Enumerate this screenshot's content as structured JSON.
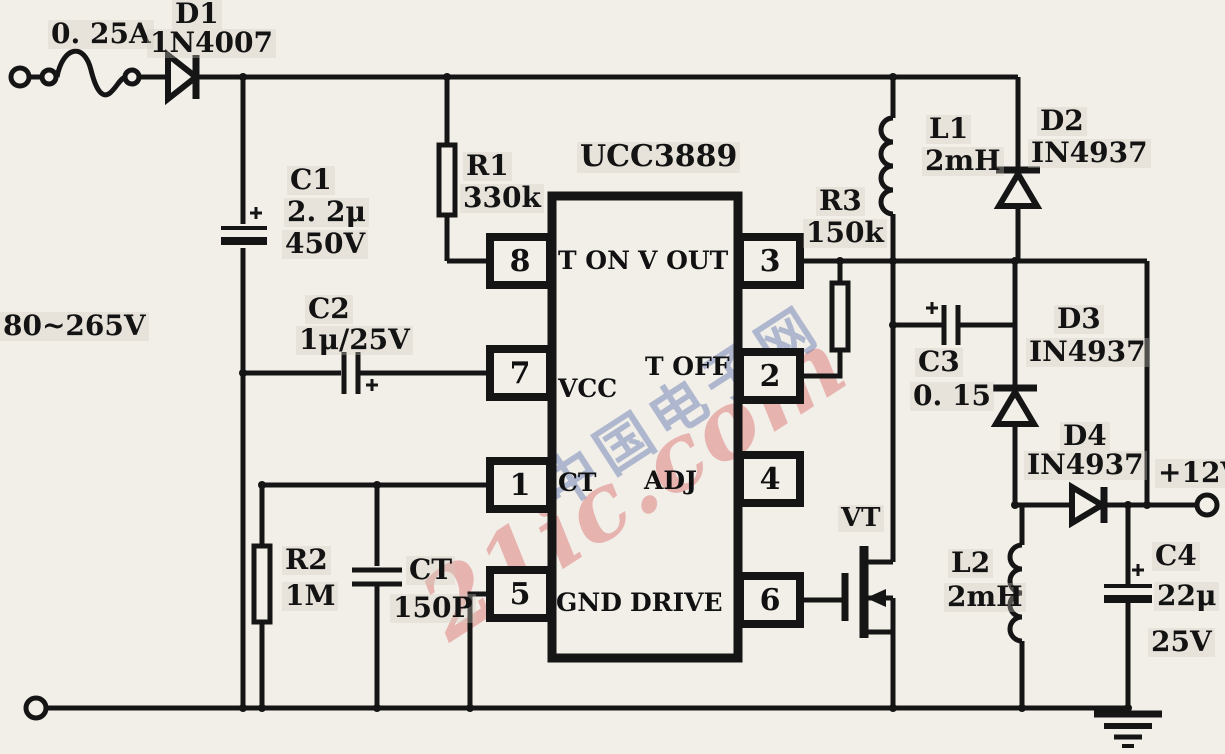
{
  "schematic": {
    "input_label": "80~265V",
    "output_label": "+12V",
    "fuse": {
      "rating": "0. 25A"
    },
    "components": {
      "d1": {
        "ref": "D1",
        "value": "1N4007"
      },
      "c1": {
        "ref": "C1",
        "value": "2. 2μ",
        "voltage": "450V"
      },
      "c2": {
        "ref": "C2",
        "value": "1μ/25V"
      },
      "r1": {
        "ref": "R1",
        "value": "330k"
      },
      "r2": {
        "ref": "R2",
        "value": "1M"
      },
      "r3": {
        "ref": "R3",
        "value": "150k"
      },
      "ct": {
        "ref": "CT",
        "value": "150P"
      },
      "c3": {
        "ref": "C3",
        "value": "0. 15"
      },
      "c4": {
        "ref": "C4",
        "value": "22μ",
        "voltage": "25V"
      },
      "l1": {
        "ref": "L1",
        "value": "2mH"
      },
      "l2": {
        "ref": "L2",
        "value": "2mH"
      },
      "d2": {
        "ref": "D2",
        "value": "IN4937"
      },
      "d3": {
        "ref": "D3",
        "value": "IN4937"
      },
      "d4": {
        "ref": "D4",
        "value": "IN4937"
      },
      "vt": {
        "ref": "VT"
      }
    },
    "ic": {
      "name": "UCC3889",
      "pins": [
        {
          "number": "8",
          "name": "T ON"
        },
        {
          "number": "7",
          "name": "VCC"
        },
        {
          "number": "1",
          "name": "CT"
        },
        {
          "number": "5",
          "name": "GND"
        },
        {
          "number": "3",
          "name": "V OUT"
        },
        {
          "number": "2",
          "name": "T OFF"
        },
        {
          "number": "4",
          "name": "ADJ"
        },
        {
          "number": "6",
          "name": "DRIVE"
        }
      ]
    },
    "watermark": {
      "cn": "中国电子网",
      "en": "21ic.com"
    }
  }
}
